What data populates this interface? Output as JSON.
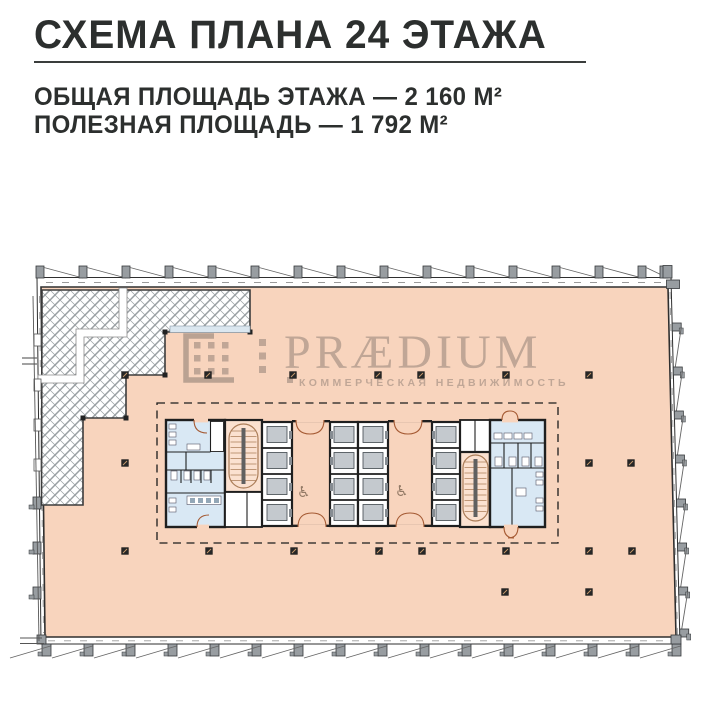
{
  "header": {
    "title": "СХЕМА ПЛАНА 24 ЭТАЖА",
    "area_total": "ОБЩАЯ ПЛОЩАДЬ ЭТАЖА — 2 160 М²",
    "area_usable": "ПОЛЕЗНАЯ ПЛОЩАДЬ — 1 792 М²"
  },
  "watermark": {
    "brand": "PRÆDIUM",
    "tagline": "КОММЕРЧЕСКАЯ НЕДВИЖИМОСТЬ"
  },
  "plan": {
    "accessible_icon": "♿",
    "colors": {
      "floor": "#f8d4bd",
      "wet_room": "#d9e8f4",
      "stair_fill": "#fbe1d0",
      "stair_line": "#ab7d58",
      "wall": "#1f1f1f",
      "door_arc": "#a55a33",
      "elevator_car": "#c4c9ce",
      "hatch_line": "#9aa0a3",
      "column": "#262626",
      "watermark_gray": "rgba(100,92,86,0.38)"
    }
  }
}
